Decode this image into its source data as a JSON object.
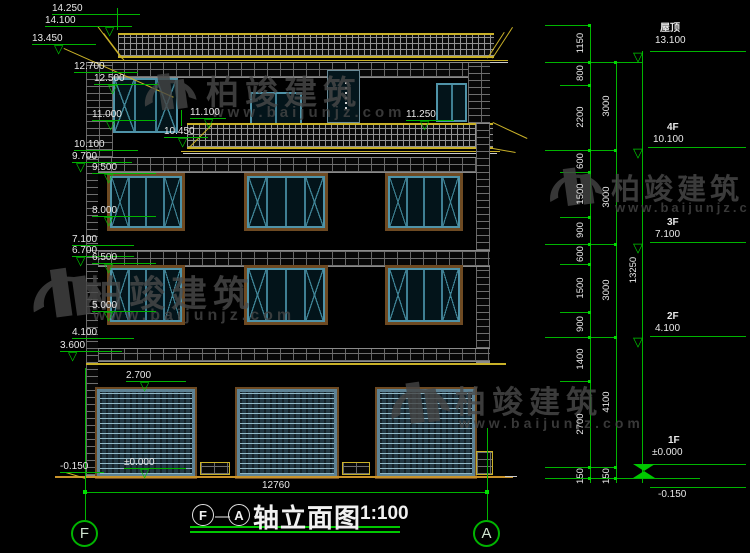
{
  "drawing": {
    "title": {
      "axis_start": "F",
      "axis_end": "A",
      "name": "轴立面图",
      "scale": "1:100"
    },
    "bottom_width_dim": "12760",
    "axis_bubbles": {
      "left": "F",
      "right": "A"
    }
  },
  "levels": [
    "14.250",
    "14.100",
    "13.450",
    "12.700",
    "12.500",
    "11.000",
    "10.100",
    "9.700",
    "9.500",
    "8.000",
    "7.100",
    "6.700",
    "6.500",
    "5.000",
    "4.100",
    "3.600",
    "2.700",
    "±0.000",
    "-0.150",
    "11.100",
    "10.450",
    "11.250"
  ],
  "right_floors": [
    {
      "name": "屋顶",
      "elev": "13.100"
    },
    {
      "name": "4F",
      "elev": "10.100"
    },
    {
      "name": "3F",
      "elev": "7.100"
    },
    {
      "name": "2F",
      "elev": "4.100"
    },
    {
      "name": "1F",
      "elev": "±0.000"
    }
  ],
  "below_ground_elev": "-0.150",
  "dim_chain_inner": [
    "1150",
    "800",
    "2200",
    "600",
    "1500",
    "900",
    "600",
    "1500",
    "900",
    "1400",
    "2700",
    "150"
  ],
  "dim_chain_floors": [
    "3000",
    "3000",
    "3000",
    "4100",
    "150"
  ],
  "dim_total": "13250",
  "watermark": {
    "brand": "柏竣建筑",
    "url": "www.baijunjz.com"
  },
  "colors": {
    "dim_green": "#00b400",
    "cad_yellow": "#c9b128",
    "ground_orange": "#c9932a",
    "window_teal": "#4f93a8",
    "frame_brown": "#6e4a22",
    "text": "#e8e8e8"
  }
}
